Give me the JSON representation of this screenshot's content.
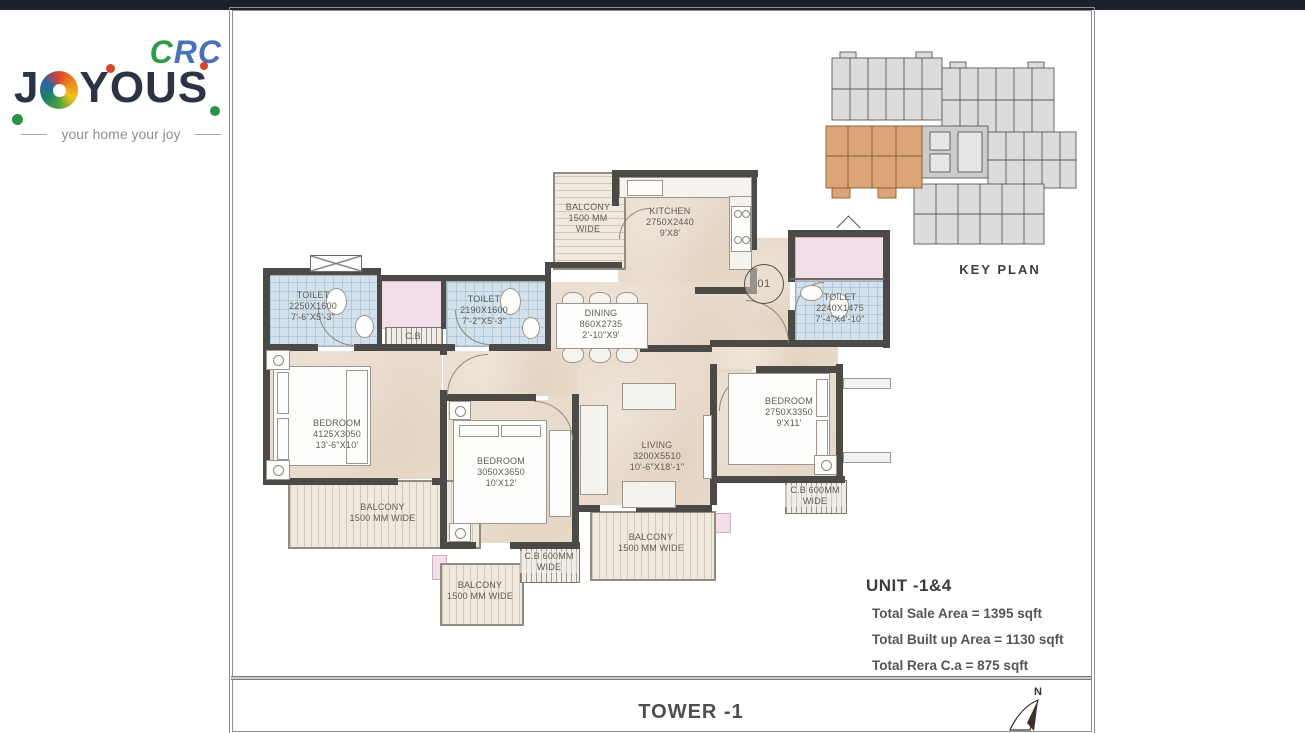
{
  "logo": {
    "crc_c": "C",
    "crc_rc": "RC",
    "joyous_j": "J",
    "joyous_rest": "YOUS",
    "tagline": "your home your joy"
  },
  "plan": {
    "rooms": {
      "toilet_left": {
        "name": "TOILET",
        "mm": "2250X1600",
        "ft": "7'-6\"X5'-3\""
      },
      "toilet_mid": {
        "name": "TOILET",
        "mm": "2190X1600",
        "ft": "7'-2\"X5'-3\""
      },
      "toilet_right": {
        "name": "TOILET",
        "mm": "2240X1475",
        "ft": "7'-4\"X4'-10\""
      },
      "kitchen": {
        "name": "KITCHEN",
        "mm": "2750X2440",
        "ft": "9'X8'"
      },
      "dining": {
        "name": "DINING",
        "mm": "860X2735",
        "ft": "2'-10\"X9'"
      },
      "living": {
        "name": "LIVING",
        "mm": "3200X5510",
        "ft": "10'-6\"X18'-1\""
      },
      "bedroom_left": {
        "name": "BEDROOM",
        "mm": "4125X3050",
        "ft": "13'-6\"X10'"
      },
      "bedroom_mid": {
        "name": "BEDROOM",
        "mm": "3050X3650",
        "ft": "10'X12'"
      },
      "bedroom_right": {
        "name": "BEDROOM",
        "mm": "2750X3350",
        "ft": "9'X11'"
      },
      "balcony_top": {
        "line1": "BALCONY",
        "line2": "1500 MM",
        "line3": "WIDE"
      },
      "balcony_left": {
        "line1": "BALCONY",
        "line2": "1500 MM WIDE"
      },
      "balcony_mid": {
        "line1": "BALCONY",
        "line2": "1500 MM WIDE"
      },
      "balcony_bottom": {
        "line1": "BALCONY",
        "line2": "1500 MM WIDE"
      },
      "cb_foyer": {
        "line1": "C.B"
      },
      "cb_bottom": {
        "line1": "C.B 600MM",
        "line2": "WIDE"
      },
      "cb_right": {
        "line1": "C.B 600MM",
        "line2": "WIDE"
      }
    },
    "entrance_door_number": "01"
  },
  "key_plan": {
    "label": "KEY PLAN",
    "highlight_color": "#dca577"
  },
  "unit_info": {
    "title": "UNIT -1&4",
    "lines": [
      "Total Sale Area = 1395 sqft",
      "Total Built up Area = 1130 sqft",
      "Total Rera C.a = 875 sqft"
    ]
  },
  "footer": {
    "tower": "TOWER -1",
    "north_label": "N"
  },
  "colors": {
    "wall": "#4b4a47",
    "floor": "#e9dbcc",
    "toilet_floor": "#d2e1eb",
    "shaft_pink": "#f3dde9",
    "keyplan_highlight": "#dca577",
    "logo_navy": "#2b3345",
    "logo_green": "#2f9b49",
    "logo_blue": "#4a72b9",
    "topbar": "#1b212b"
  }
}
